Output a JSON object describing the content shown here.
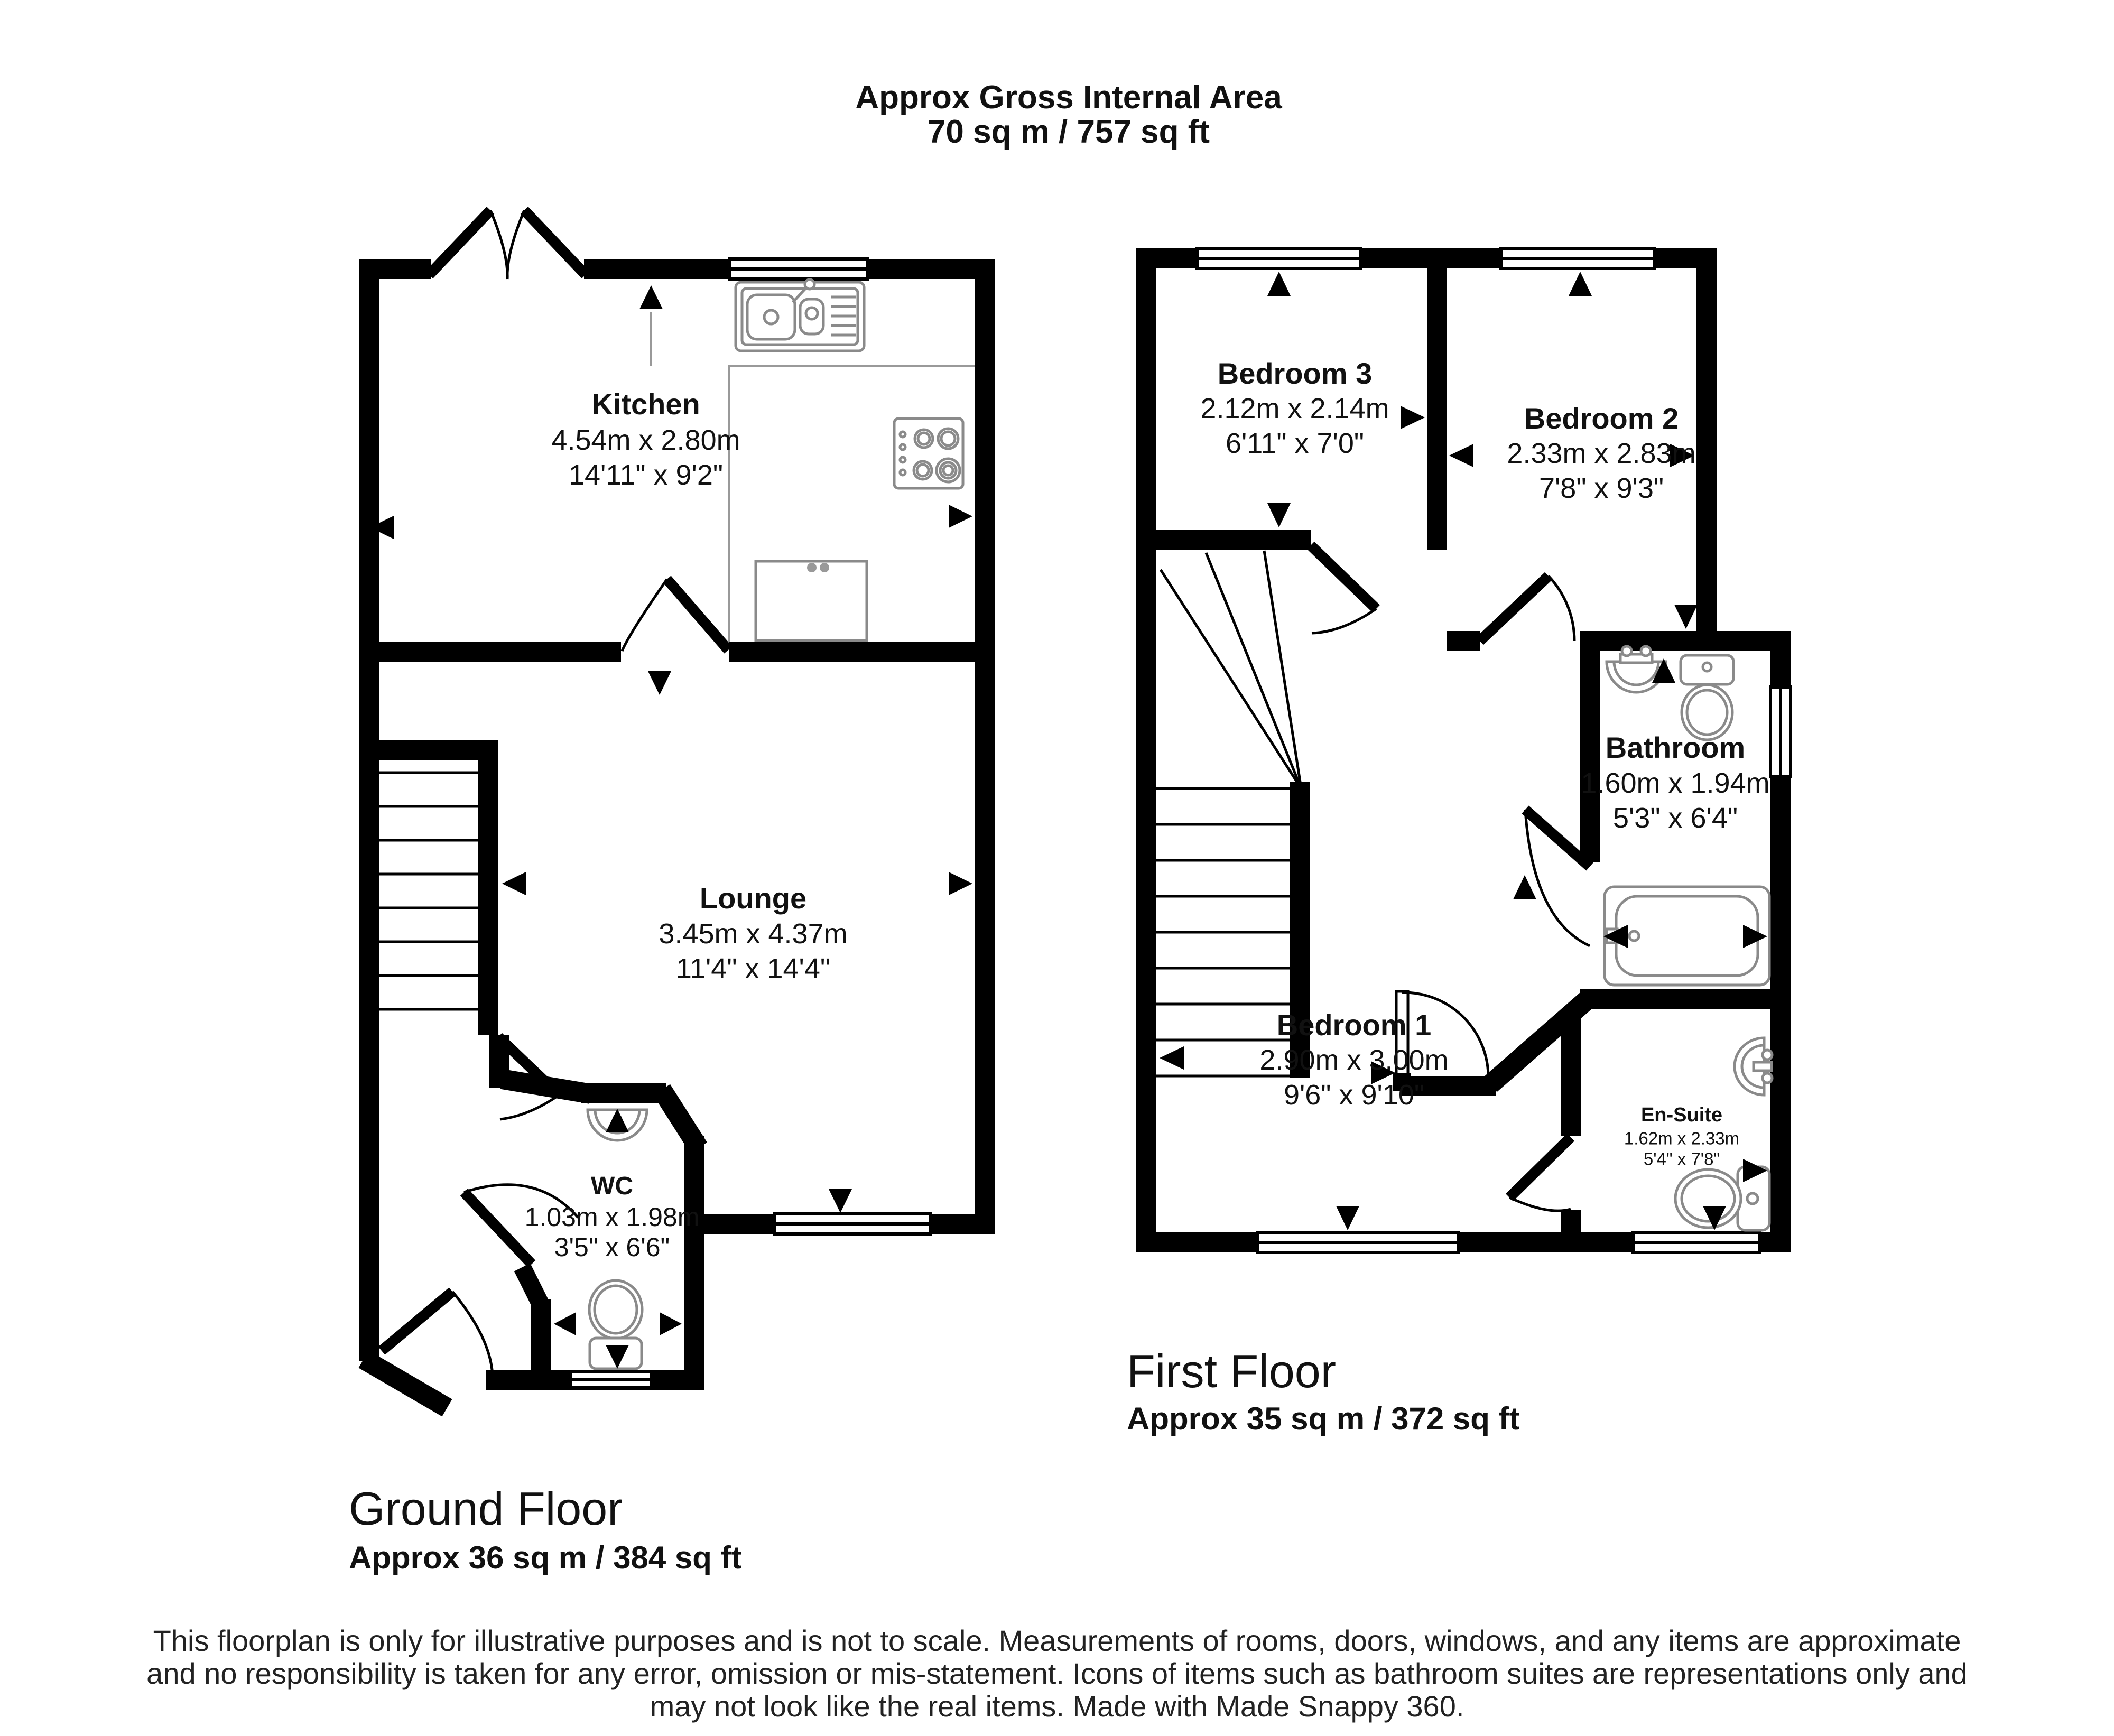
{
  "title": {
    "line1": "Approx Gross Internal Area",
    "line2": "70 sq m / 757 sq ft"
  },
  "floors": {
    "ground": {
      "name": "Ground Floor",
      "area": "Approx 36 sq m / 384 sq ft",
      "rooms": {
        "kitchen": {
          "name": "Kitchen",
          "metric": "4.54m x 2.80m",
          "imperial": "14'11\" x 9'2\""
        },
        "lounge": {
          "name": "Lounge",
          "metric": "3.45m x 4.37m",
          "imperial": "11'4\" x 14'4\""
        },
        "wc": {
          "name": "WC",
          "metric": "1.03m x 1.98m",
          "imperial": "3'5\" x 6'6\""
        }
      }
    },
    "first": {
      "name": "First Floor",
      "area": "Approx 35 sq m / 372 sq ft",
      "rooms": {
        "bedroom3": {
          "name": "Bedroom 3",
          "metric": "2.12m x 2.14m",
          "imperial": "6'11\" x 7'0\""
        },
        "bedroom2": {
          "name": "Bedroom 2",
          "metric": "2.33m x 2.83m",
          "imperial": "7'8\" x 9'3\""
        },
        "bathroom": {
          "name": "Bathroom",
          "metric": "1.60m x 1.94m",
          "imperial": "5'3\" x 6'4\""
        },
        "bedroom1": {
          "name": "Bedroom 1",
          "metric": "2.90m x 3.00m",
          "imperial": "9'6\" x 9'10\""
        },
        "ensuite": {
          "name": "En-Suite",
          "metric": "1.62m x 2.33m",
          "imperial": "5'4\" x 7'8\""
        }
      }
    }
  },
  "disclaimer": {
    "line1": "This floorplan is only for illustrative purposes and is not to scale. Measurements of rooms, doors, windows, and any items are approximate",
    "line2": "and no responsibility is taken for any error, omission or mis-statement. Icons of items such as bathroom suites are representations only and",
    "line3": "may not look like the real items. Made with Made Snappy 360."
  },
  "colors": {
    "wall": "#000000",
    "fixture_outline": "#8a8a8a",
    "text": "#111111",
    "background": "#ffffff"
  },
  "icons": [
    "kitchen-sink-icon",
    "hob-icon",
    "appliance-icon",
    "wc-basin-icon",
    "wc-toilet-icon",
    "bathroom-sink-icon",
    "bathroom-toilet-icon",
    "bathtub-icon",
    "ensuite-sink-icon",
    "ensuite-toilet-icon",
    "window-icon",
    "door-arc-icon",
    "stairs-icon",
    "measurement-arrow-icon"
  ]
}
